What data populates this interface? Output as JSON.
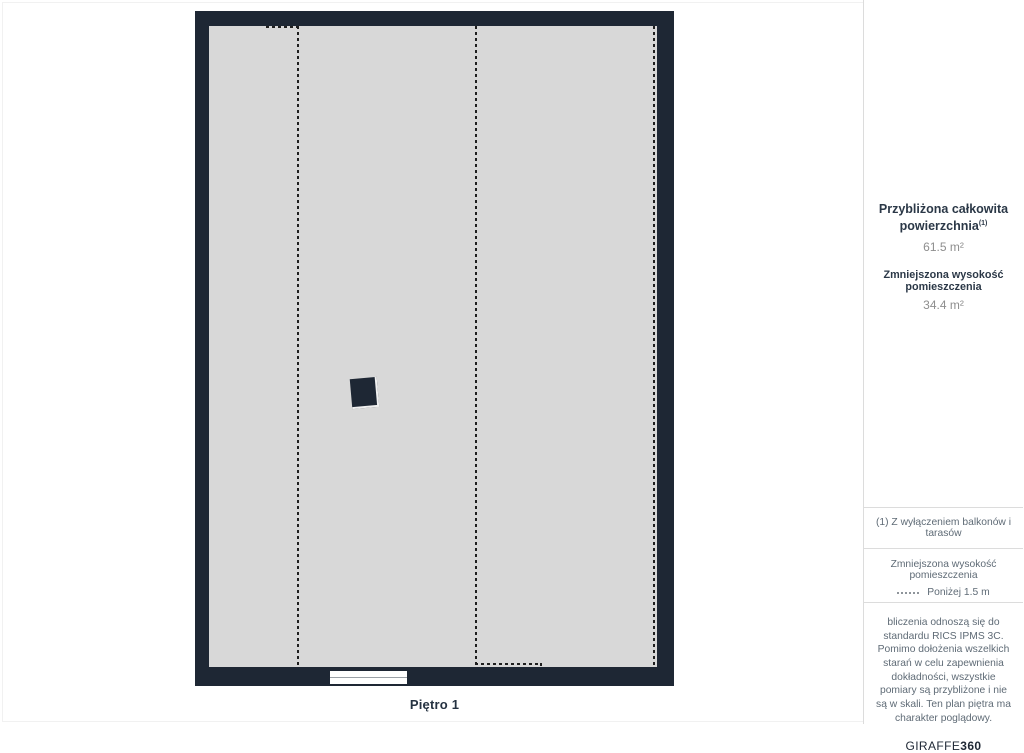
{
  "floor_plan": {
    "label": "Piętro 1",
    "wall_color": "#1e2734",
    "floor_color": "#d8d8d8",
    "dashed_line_color": "#1f1f1f",
    "dashed_line_meaning": "Zmniejszona wysokość pomieszczenia (poniżej 1.5 m)"
  },
  "summary": {
    "total_label_line1": "Przybliżona całkowita",
    "total_label_line2": "powierzchnia",
    "total_footnote_marker": "(1)",
    "total_value": "61.5 m²",
    "reduced_label": "Zmniejszona wysokość pomieszczenia",
    "reduced_value": "34.4 m²"
  },
  "footnote": {
    "text": "(1) Z wyłączeniem balkonów i tarasów"
  },
  "legend": {
    "title": "Zmniejszona wysokość pomieszczenia",
    "item_label": "Poniżej 1.5 m"
  },
  "disclaimer": {
    "text": "bliczenia odnoszą się do standardu RICS IPMS 3C. Pomimo dołożenia wszelkich starań w celu zapewnienia dokładności, wszystkie pomiary są przybliżone i nie są w skali. Ten plan piętra ma charakter poglądowy."
  },
  "brand": {
    "name_regular": "GIRAFFE",
    "name_bold": "360"
  },
  "colors": {
    "heading": "#2b3847",
    "value": "#8e8e8e",
    "muted_text": "#5f6b76",
    "divider": "#dcdcdc"
  }
}
